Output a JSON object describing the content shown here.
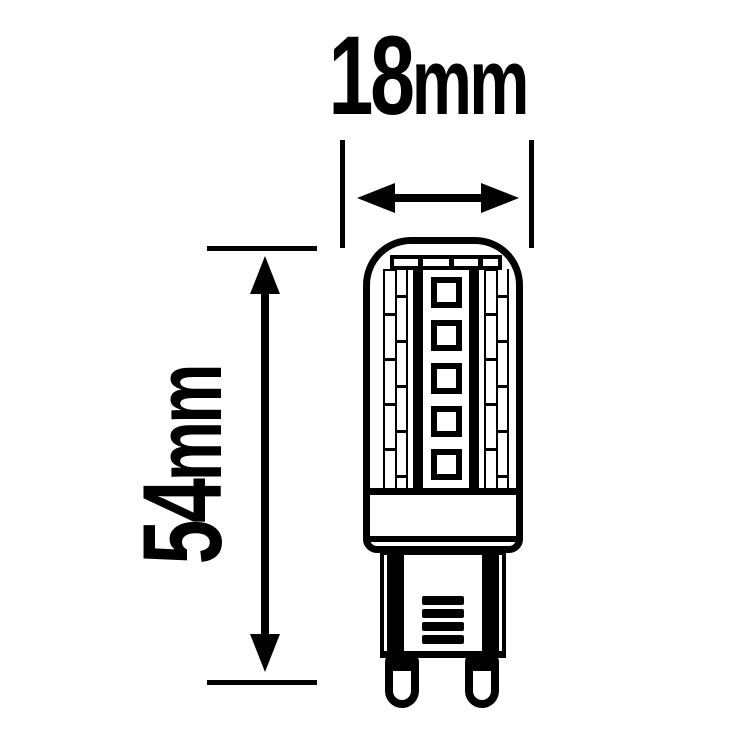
{
  "page": {
    "background_color": "#ffffff",
    "line_color": "#000000"
  },
  "diagram": {
    "type": "technical-dimension-drawing",
    "subject": "G9 LED capsule bulb",
    "width_dimension": {
      "value": "18",
      "unit": "mm",
      "label": "18mm"
    },
    "height_dimension": {
      "value": "54",
      "unit": "mm",
      "label": "54mm"
    },
    "bulb": {
      "center_led_count": 5,
      "side_strip_count": 2,
      "side_cells_per_column": 6,
      "cap_divider_count": 3,
      "vent_slat_count": 4,
      "pin_count": 2
    }
  }
}
